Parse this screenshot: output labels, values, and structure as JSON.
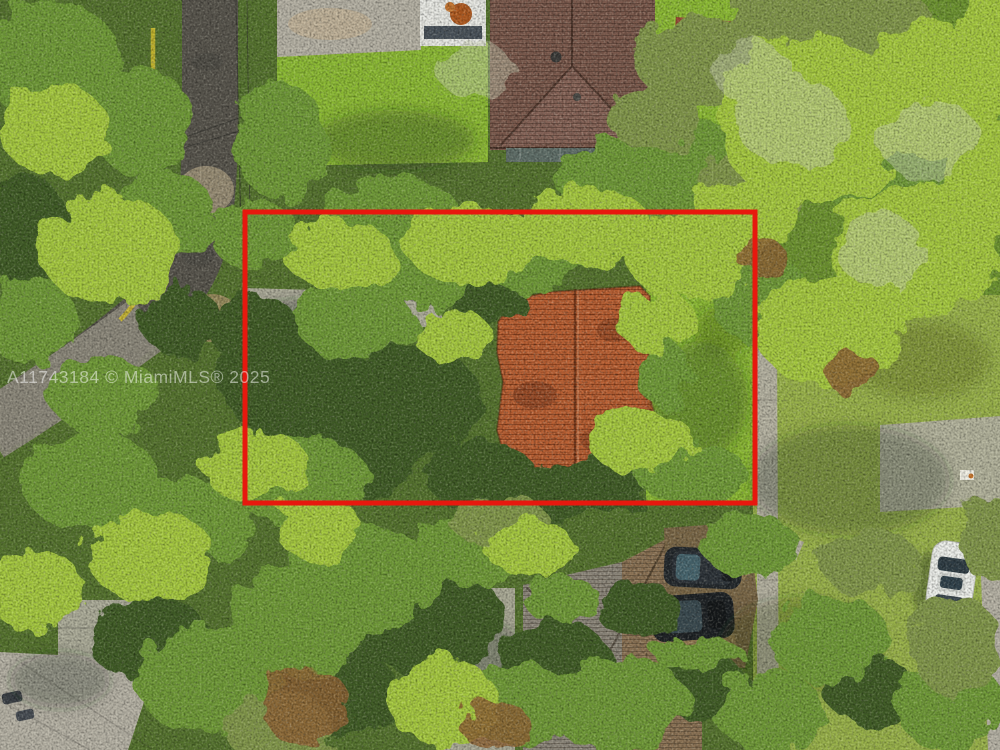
{
  "meta": {
    "kind": "aerial-drone-real-estate-photo",
    "description": "Top-down aerial photograph of a heavily wooded residential lot with a terracotta tile roof house, outlined by a red property boundary rectangle. Neighboring houses, a curving street at left, parked cars and sidewalks are visible."
  },
  "watermark": {
    "text": "A11743184 © MiamiMLS® 2025",
    "opacity": 0.5
  },
  "annotation": {
    "boundary_label": "property-boundary-outline"
  },
  "palette": {
    "boundary_red": "#e7180e",
    "canopy_base": "#55732e",
    "canopy_bright": "#a6c93f",
    "canopy_mid": "#6f9a37",
    "canopy_dark": "#3f5c28",
    "canopy_sage": "#82974b",
    "canopy_rust": "#8f6434",
    "canopy_pale": "#c9cfb4",
    "lawn_green": "#8cba34",
    "lawn_olive": "#9fae56",
    "asphalt_gray": "#57544c",
    "road_light": "#8f8b7d",
    "concrete": "#b6b2a5",
    "driveway_dirt": "#7a6747",
    "roof_terracotta": "#bb6134",
    "roof_brown": "#7d5b4e",
    "roof_gray_brown": "#8e887c",
    "roof_tan": "#8c7355",
    "curb_yellow": "#cdbb2d",
    "car_white": "#eef0ec",
    "car_dark": "#23282c",
    "watermark_white": "#ffffff"
  }
}
